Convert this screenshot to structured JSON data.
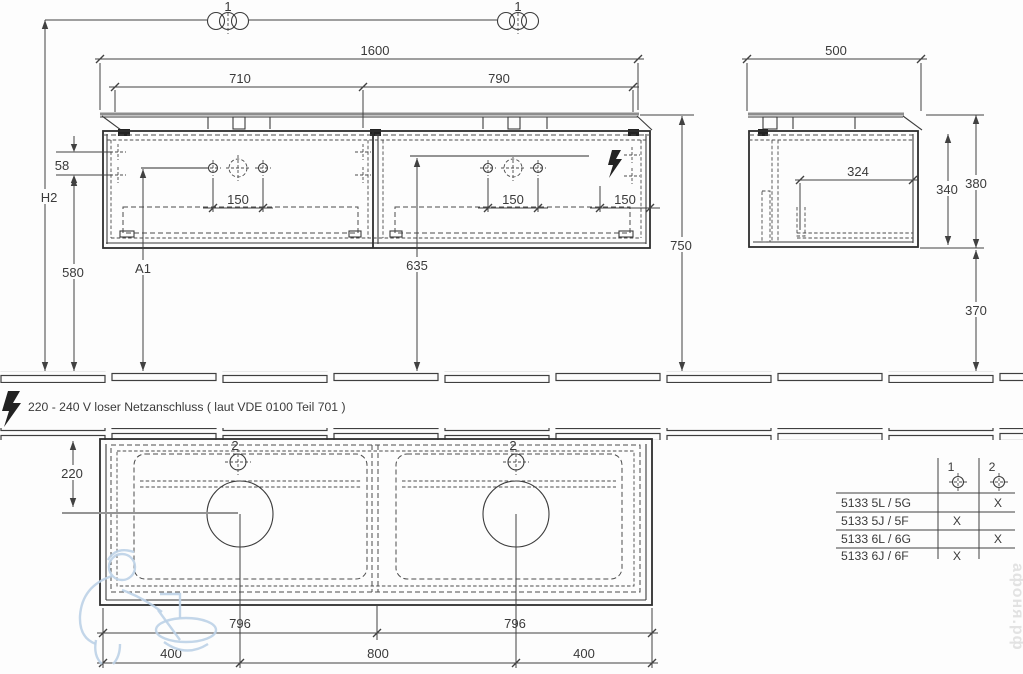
{
  "front_view": {
    "hinge_callout_left": "1",
    "hinge_callout_right": "1",
    "dim_total_width": "1600",
    "dim_left_section": "710",
    "dim_right_section": "790",
    "dim_hole_offset": "58",
    "dim_wall_height": "H2",
    "dim_hole_spacing_left": "150",
    "dim_hole_spacing_mid": "150",
    "dim_hole_spacing_right": "150",
    "dim_580": "580",
    "dim_a1": "A1",
    "dim_635": "635",
    "dim_750": "750"
  },
  "side_view": {
    "dim_depth": "500",
    "dim_inner_depth": "324",
    "dim_cabinet_height": "340",
    "dim_total_height": "380",
    "dim_floor_clearance": "370"
  },
  "plan_view": {
    "dim_front_offset": "220",
    "faucet_callout_left": "2",
    "faucet_callout_right": "2",
    "dim_basin_left": "796",
    "dim_basin_right": "796",
    "dim_400_left": "400",
    "dim_800_center": "800",
    "dim_400_right": "400"
  },
  "note": {
    "power_text": "220 - 240 V loser Netzanschluss ( laut VDE 0100 Teil 701 )"
  },
  "variant_table": {
    "col_1_label": "1",
    "col_2_label": "2",
    "rows": [
      {
        "model": "5133 5L / 5G",
        "pos1": "",
        "pos2": "X"
      },
      {
        "model": "5133 5J / 5F",
        "pos1": "X",
        "pos2": ""
      },
      {
        "model": "5133 6L / 6G",
        "pos1": "",
        "pos2": "X"
      },
      {
        "model": "5133 6J / 6F",
        "pos1": "X",
        "pos2": ""
      }
    ]
  },
  "watermark": {
    "site_text": "афоня.рф"
  }
}
